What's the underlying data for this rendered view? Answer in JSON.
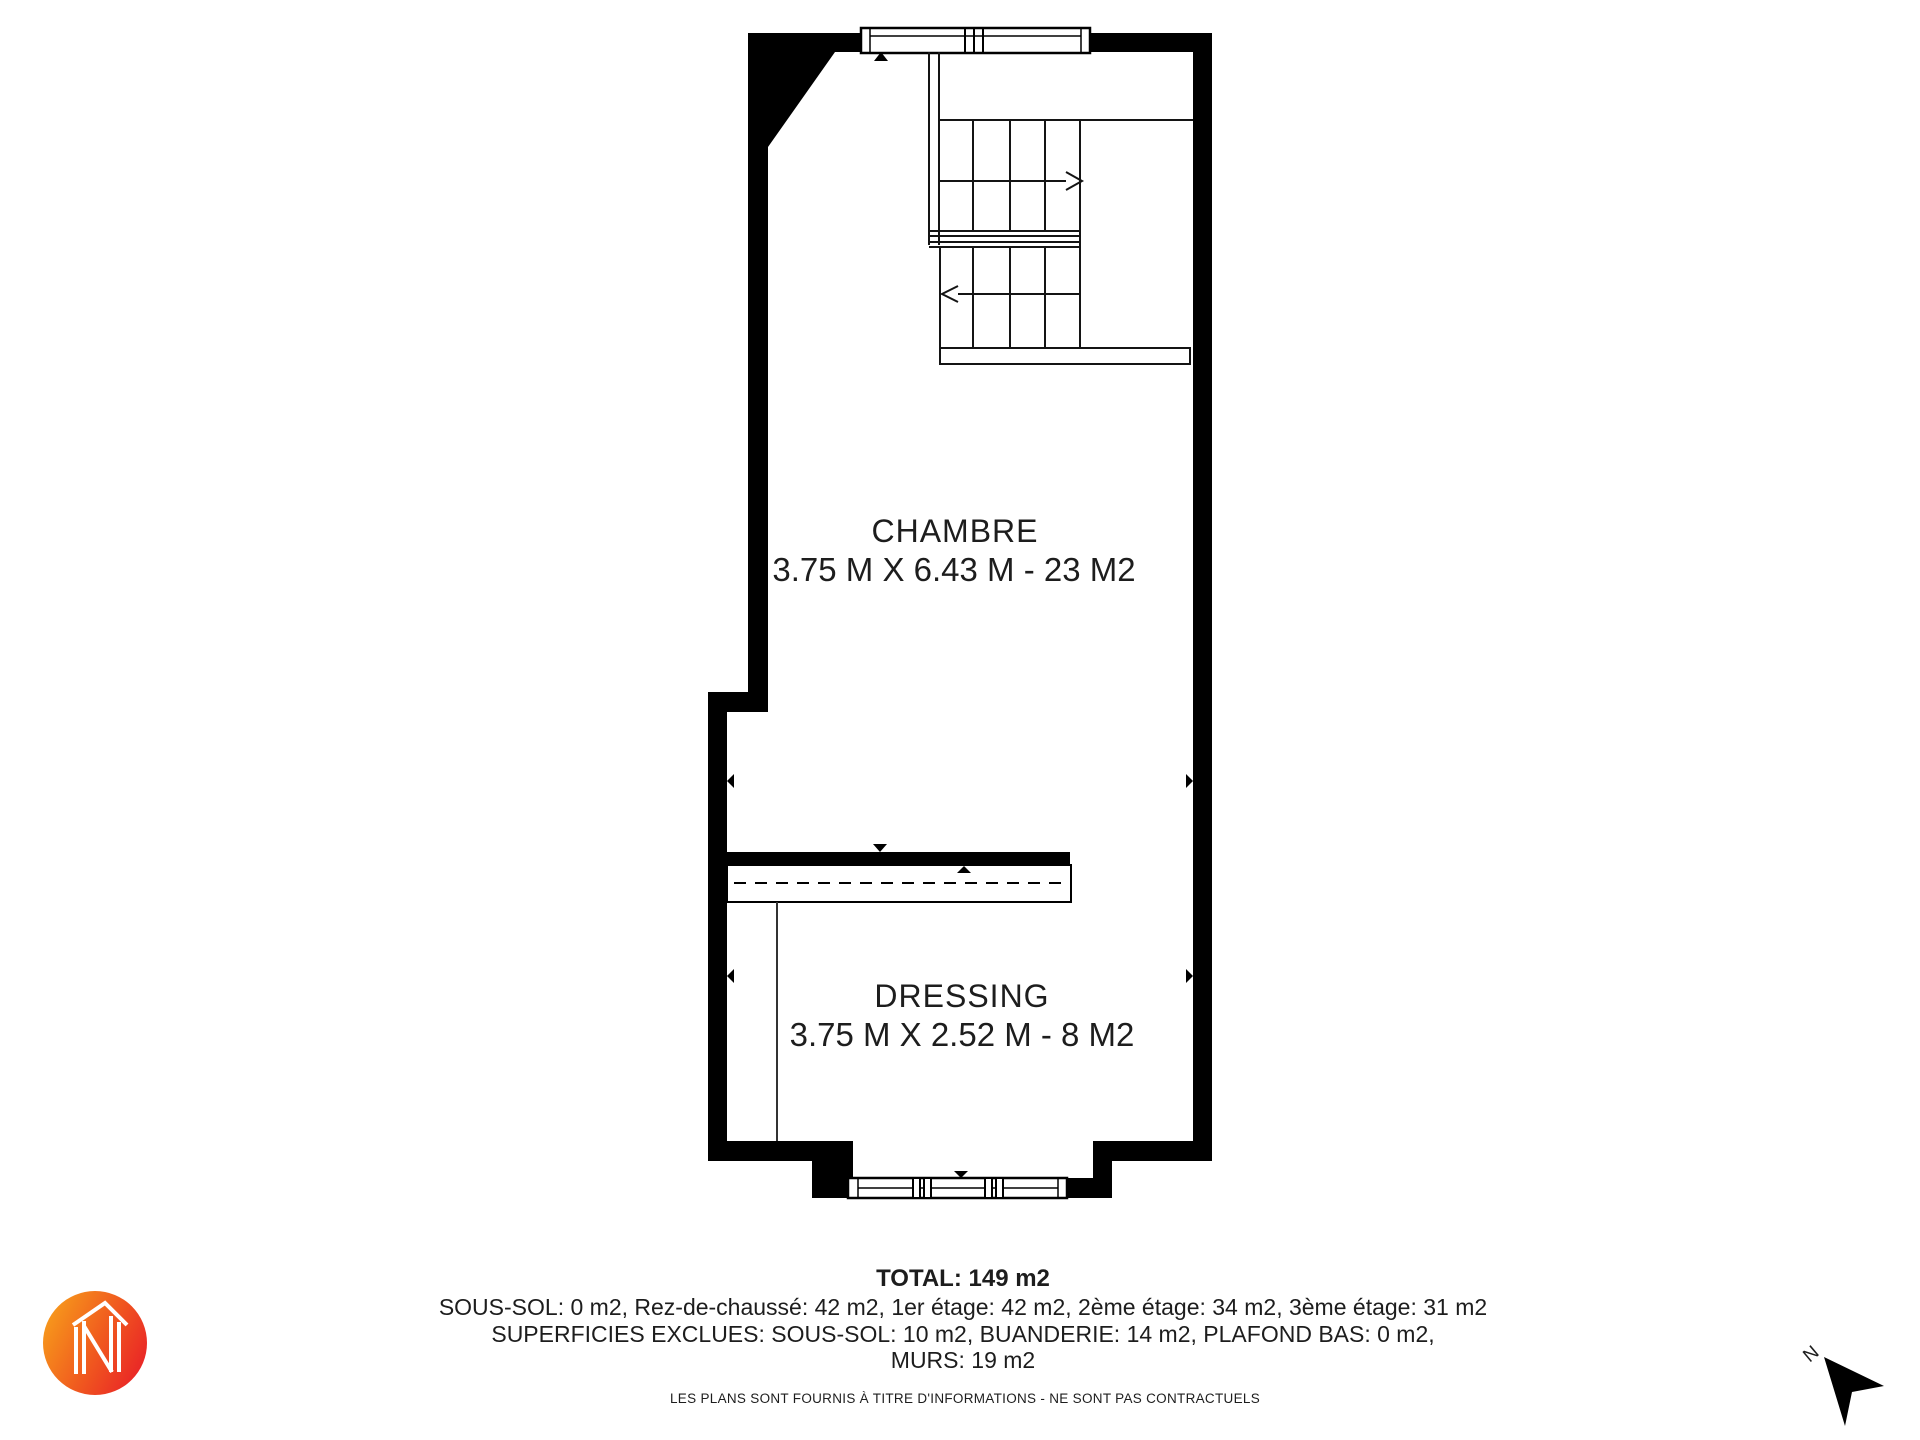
{
  "page": {
    "background": "#ffffff"
  },
  "plan": {
    "rooms": [
      {
        "name": "CHAMBRE",
        "dimensions": "3.75 M X 6.43 M - 23 M2"
      },
      {
        "name": "DRESSING",
        "dimensions": "3.75 M X 2.52 M - 8 M2"
      }
    ],
    "compass": {
      "label": "N"
    }
  },
  "summary": {
    "total": "TOTAL: 149 m2",
    "floors": "SOUS-SOL: 0 m2, Rez-de-chaussé: 42 m2, 1er étage: 42 m2, 2ème étage: 34 m2, 3ème étage: 31 m2",
    "excluded": "SUPERFICIES EXCLUES: SOUS-SOL: 10 m2, BUANDERIE: 14 m2, PLAFOND BAS: 0 m2,",
    "walls": "MURS: 19 m2"
  },
  "footer": {
    "disclaimer": "LES PLANS SONT FOURNIS À TITRE D'INFORMATIONS - NE SONT PAS CONTRACTUELS"
  },
  "colors": {
    "wall": "#000000",
    "line": "#111111",
    "text": "#1d1d1d",
    "logo_gradient_start": "#F79B1B",
    "logo_gradient_end": "#E92227"
  }
}
